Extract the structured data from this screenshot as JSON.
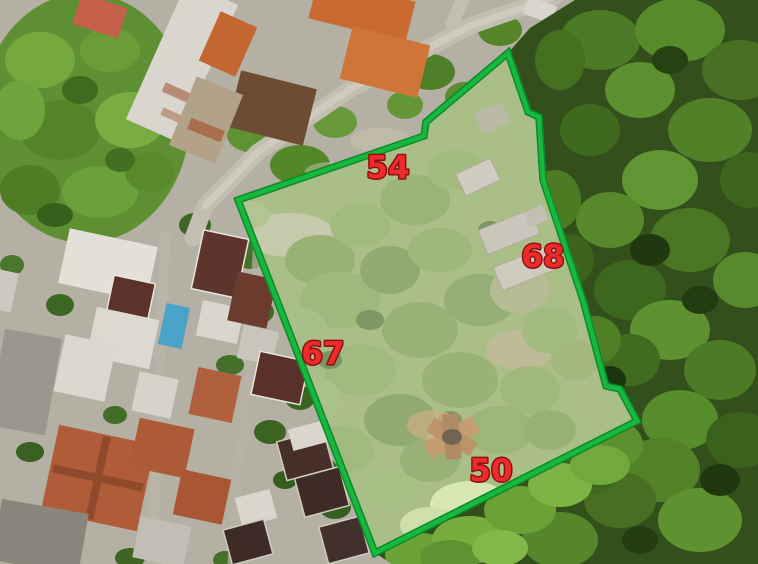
{
  "plot": {
    "boundary_color": "#17b83e",
    "label_color": "#ee2b2b",
    "label_outline_color": "#8c1212",
    "measurements": [
      {
        "side": "top",
        "value": "54"
      },
      {
        "side": "right",
        "value": "68"
      },
      {
        "side": "left",
        "value": "67"
      },
      {
        "side": "bottom",
        "value": "50"
      }
    ]
  },
  "colors": {
    "forest_base": "#324f1c",
    "plot_haze": "#ffffff",
    "road": "#c2beb1",
    "roof_terracotta": "#b05c38",
    "roof_dark": "#473029",
    "pool": "#4aa3c8"
  }
}
